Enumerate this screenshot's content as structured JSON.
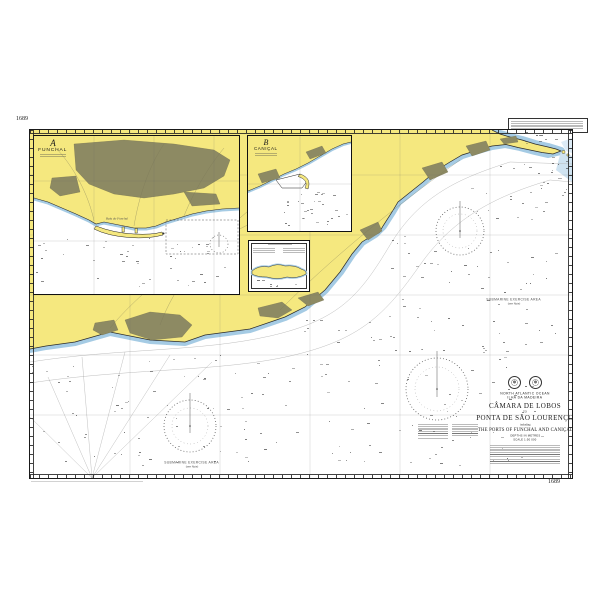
{
  "chart": {
    "number": "1689",
    "title_block": {
      "sea_area": "NORTH ATLANTIC OCEAN",
      "region": "ILHA DA MADEIRA",
      "title_line1": "CÂMARA DE LOBOS",
      "joiner": "TO",
      "title_line2": "PONTA DE SÃO LOURENÇO",
      "including": "including",
      "subtitle": "THE PORTS OF FUNCHAL AND CANIÇAL",
      "depths_note": "DEPTHS IN METRES",
      "scale_note": "SCALE 1:50 000"
    },
    "insets": {
      "a": {
        "letter": "A",
        "name": "FUNCHAL"
      },
      "b": {
        "letter": "B",
        "name": "CANIÇAL"
      }
    },
    "sea_labels": {
      "bay": "Baía do Funchal",
      "submarine_area": "SUBMARINE EXERCISE AREA",
      "see_note": "(see Note)"
    },
    "colors": {
      "land": "#f5e87f",
      "urban": "#8d8a63",
      "shallow": "#a5cbe4",
      "neatline": "#1a1a1a"
    }
  }
}
